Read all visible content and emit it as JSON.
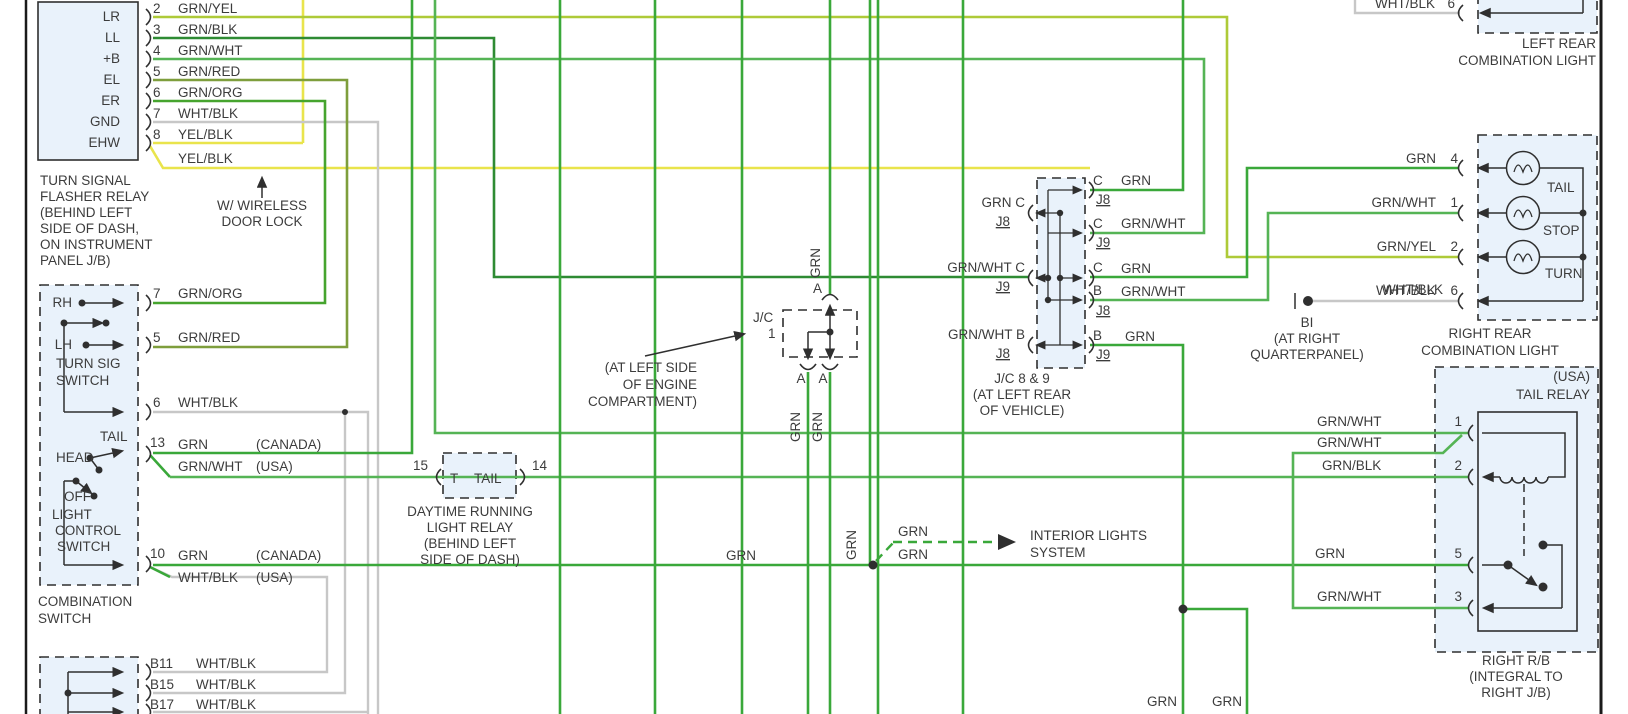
{
  "diagram_title": "Turn signal / tail light wiring diagram section",
  "colors": {
    "grn": "#3aa83a",
    "grnwht": "#55b455",
    "grnblk": "#2e8b33",
    "grnred": "#7e9e3c",
    "grnorg": "#46a42e",
    "grnyel": "#aeca38",
    "yel": "#e9e44c",
    "gry": "#c7c7c7",
    "ink": "#2f2f2f",
    "text": "#3c3c3c",
    "boxfill": "#e9f2fb"
  },
  "components": [
    {
      "name": "turn-signal-flasher-relay",
      "labels": [
        {
          "t": "LR",
          "x": 120,
          "y": 21,
          "a": "end"
        },
        {
          "t": "LL",
          "x": 120,
          "y": 42,
          "a": "end"
        },
        {
          "t": "+B",
          "x": 120,
          "y": 63,
          "a": "end"
        },
        {
          "t": "EL",
          "x": 120,
          "y": 84,
          "a": "end"
        },
        {
          "t": "ER",
          "x": 120,
          "y": 105,
          "a": "end"
        },
        {
          "t": "GND",
          "x": 120,
          "y": 126,
          "a": "end"
        },
        {
          "t": "EHW",
          "x": 120,
          "y": 147,
          "a": "end"
        },
        {
          "t": "2",
          "x": 153,
          "y": 13
        },
        {
          "t": "GRN/YEL",
          "x": 178,
          "y": 13
        },
        {
          "t": "3",
          "x": 153,
          "y": 34
        },
        {
          "t": "GRN/BLK",
          "x": 178,
          "y": 34
        },
        {
          "t": "4",
          "x": 153,
          "y": 55
        },
        {
          "t": "GRN/WHT",
          "x": 178,
          "y": 55
        },
        {
          "t": "5",
          "x": 153,
          "y": 76
        },
        {
          "t": "GRN/RED",
          "x": 178,
          "y": 76
        },
        {
          "t": "6",
          "x": 153,
          "y": 97
        },
        {
          "t": "GRN/ORG",
          "x": 178,
          "y": 97
        },
        {
          "t": "7",
          "x": 153,
          "y": 118
        },
        {
          "t": "WHT/BLK",
          "x": 178,
          "y": 118
        },
        {
          "t": "8",
          "x": 153,
          "y": 139
        },
        {
          "t": "YEL/BLK",
          "x": 178,
          "y": 139
        },
        {
          "t": "YEL/BLK",
          "x": 178,
          "y": 163
        },
        {
          "t": "TURN SIGNAL",
          "x": 40,
          "y": 185
        },
        {
          "t": "FLASHER RELAY",
          "x": 40,
          "y": 201
        },
        {
          "t": "(BEHIND LEFT",
          "x": 40,
          "y": 217
        },
        {
          "t": "SIDE OF DASH,",
          "x": 40,
          "y": 233
        },
        {
          "t": "ON INSTRUMENT",
          "x": 40,
          "y": 249
        },
        {
          "t": "PANEL J/B)",
          "x": 40,
          "y": 265
        },
        {
          "t": "W/ WIRELESS",
          "x": 262,
          "y": 210,
          "a": "middle"
        },
        {
          "t": "DOOR LOCK",
          "x": 262,
          "y": 226,
          "a": "middle"
        }
      ]
    },
    {
      "name": "combination-switch",
      "labels": [
        {
          "t": "RH",
          "x": 72,
          "y": 307,
          "a": "end"
        },
        {
          "t": "LH",
          "x": 72,
          "y": 349,
          "a": "end"
        },
        {
          "t": "TURN SIG",
          "x": 56,
          "y": 368
        },
        {
          "t": "SWITCH",
          "x": 56,
          "y": 385
        },
        {
          "t": "7",
          "x": 153,
          "y": 298
        },
        {
          "t": "GRN/ORG",
          "x": 178,
          "y": 298
        },
        {
          "t": "5",
          "x": 153,
          "y": 342
        },
        {
          "t": "GRN/RED",
          "x": 178,
          "y": 342
        },
        {
          "t": "6",
          "x": 153,
          "y": 407
        },
        {
          "t": "WHT/BLK",
          "x": 178,
          "y": 407
        },
        {
          "t": "TAIL",
          "x": 100,
          "y": 441
        },
        {
          "t": "HEAD",
          "x": 56,
          "y": 462
        },
        {
          "t": "13",
          "x": 150,
          "y": 447
        },
        {
          "t": "GRN",
          "x": 178,
          "y": 449
        },
        {
          "t": "(CANADA)",
          "x": 256,
          "y": 449
        },
        {
          "t": "GRN/WHT",
          "x": 178,
          "y": 471
        },
        {
          "t": "(USA)",
          "x": 256,
          "y": 471
        },
        {
          "t": "OFF",
          "x": 64,
          "y": 501
        },
        {
          "t": "LIGHT",
          "x": 52,
          "y": 519
        },
        {
          "t": "CONTROL",
          "x": 55,
          "y": 535
        },
        {
          "t": "SWITCH",
          "x": 57,
          "y": 551
        },
        {
          "t": "10",
          "x": 150,
          "y": 558
        },
        {
          "t": "GRN",
          "x": 178,
          "y": 560
        },
        {
          "t": "(CANADA)",
          "x": 256,
          "y": 560
        },
        {
          "t": "WHT/BLK",
          "x": 178,
          "y": 582
        },
        {
          "t": "(USA)",
          "x": 256,
          "y": 582
        },
        {
          "t": "COMBINATION",
          "x": 38,
          "y": 606
        },
        {
          "t": "SWITCH",
          "x": 38,
          "y": 623
        }
      ]
    },
    {
      "name": "instrument-panel-connector",
      "labels": [
        {
          "t": "B11",
          "x": 150,
          "y": 668
        },
        {
          "t": "WHT/BLK",
          "x": 196,
          "y": 668
        },
        {
          "t": "B15",
          "x": 150,
          "y": 689
        },
        {
          "t": "WHT/BLK",
          "x": 196,
          "y": 689
        },
        {
          "t": "B17",
          "x": 150,
          "y": 709
        },
        {
          "t": "WHT/BLK",
          "x": 196,
          "y": 709
        }
      ]
    },
    {
      "name": "daytime-running-light-relay",
      "labels": [
        {
          "t": "15",
          "x": 428,
          "y": 470,
          "a": "end"
        },
        {
          "t": "T",
          "x": 450,
          "y": 483
        },
        {
          "t": "TAIL",
          "x": 474,
          "y": 483
        },
        {
          "t": "14",
          "x": 532,
          "y": 470
        },
        {
          "t": "DAYTIME RUNNING",
          "x": 470,
          "y": 516,
          "a": "middle"
        },
        {
          "t": "LIGHT RELAY",
          "x": 470,
          "y": 532,
          "a": "middle"
        },
        {
          "t": "(BEHIND LEFT",
          "x": 470,
          "y": 548,
          "a": "middle"
        },
        {
          "t": "SIDE OF DASH)",
          "x": 470,
          "y": 564,
          "a": "middle"
        }
      ]
    },
    {
      "name": "junction-connector-1",
      "labels": [
        {
          "t": "A",
          "x": 822,
          "y": 293,
          "a": "end"
        },
        {
          "t": "J/C",
          "x": 753,
          "y": 322
        },
        {
          "t": "1",
          "x": 768,
          "y": 338
        },
        {
          "t": "A",
          "x": 801,
          "y": 383,
          "a": "middle"
        },
        {
          "t": "A",
          "x": 823,
          "y": 383,
          "a": "middle"
        },
        {
          "t": "GRN",
          "x": 820,
          "y": 278,
          "r": true
        },
        {
          "t": "GRN",
          "x": 800,
          "y": 442,
          "r": true
        },
        {
          "t": "GRN",
          "x": 822,
          "y": 442,
          "r": true
        },
        {
          "t": "(AT LEFT SIDE",
          "x": 697,
          "y": 372,
          "a": "end"
        },
        {
          "t": "OF ENGINE",
          "x": 697,
          "y": 389,
          "a": "end"
        },
        {
          "t": "COMPARTMENT)",
          "x": 697,
          "y": 406,
          "a": "end"
        }
      ]
    },
    {
      "name": "junction-connector-8-9",
      "labels": [
        {
          "t": "GRN  C",
          "x": 1025,
          "y": 207,
          "a": "end"
        },
        {
          "t": "J8",
          "x": 1010,
          "y": 226,
          "a": "end",
          "u": true
        },
        {
          "t": "GRN/WHT  C",
          "x": 1025,
          "y": 272,
          "a": "end"
        },
        {
          "t": "J9",
          "x": 1010,
          "y": 291,
          "a": "end",
          "u": true
        },
        {
          "t": "GRN/WHT  B",
          "x": 1025,
          "y": 339,
          "a": "end"
        },
        {
          "t": "J8",
          "x": 1010,
          "y": 358,
          "a": "end",
          "u": true
        },
        {
          "t": "C",
          "x": 1093,
          "y": 185
        },
        {
          "t": "GRN",
          "x": 1121,
          "y": 185
        },
        {
          "t": "J8",
          "x": 1096,
          "y": 204,
          "u": true
        },
        {
          "t": "C",
          "x": 1093,
          "y": 228
        },
        {
          "t": "GRN/WHT",
          "x": 1121,
          "y": 228
        },
        {
          "t": "J9",
          "x": 1096,
          "y": 247,
          "u": true
        },
        {
          "t": "C",
          "x": 1093,
          "y": 272
        },
        {
          "t": "GRN",
          "x": 1121,
          "y": 273
        },
        {
          "t": "B",
          "x": 1093,
          "y": 295
        },
        {
          "t": "GRN/WHT",
          "x": 1121,
          "y": 296
        },
        {
          "t": "J8",
          "x": 1096,
          "y": 315,
          "u": true
        },
        {
          "t": "B",
          "x": 1093,
          "y": 340
        },
        {
          "t": "GRN",
          "x": 1125,
          "y": 341
        },
        {
          "t": "J9",
          "x": 1096,
          "y": 359,
          "u": true
        },
        {
          "t": "J/C 8 & 9",
          "x": 1022,
          "y": 383,
          "a": "middle"
        },
        {
          "t": "(AT LEFT REAR",
          "x": 1022,
          "y": 399,
          "a": "middle"
        },
        {
          "t": "OF VEHICLE)",
          "x": 1022,
          "y": 415,
          "a": "middle"
        }
      ]
    },
    {
      "name": "ground-bi",
      "labels": [
        {
          "t": "WHT/BLK",
          "x": 1383,
          "y": 294
        },
        {
          "t": "BI",
          "x": 1307,
          "y": 327,
          "a": "middle"
        },
        {
          "t": "(AT RIGHT",
          "x": 1307,
          "y": 343,
          "a": "middle"
        },
        {
          "t": "QUARTERPANEL)",
          "x": 1307,
          "y": 359,
          "a": "middle"
        }
      ]
    },
    {
      "name": "right-rear-combination-light",
      "labels": [
        {
          "t": "GRN",
          "x": 1436,
          "y": 163,
          "a": "end"
        },
        {
          "t": "4",
          "x": 1458,
          "y": 163,
          "a": "end"
        },
        {
          "t": "GRN/WHT",
          "x": 1436,
          "y": 207,
          "a": "end"
        },
        {
          "t": "1",
          "x": 1458,
          "y": 207,
          "a": "end"
        },
        {
          "t": "GRN/YEL",
          "x": 1436,
          "y": 251,
          "a": "end"
        },
        {
          "t": "2",
          "x": 1458,
          "y": 251,
          "a": "end"
        },
        {
          "t": "WHT/BLK",
          "x": 1436,
          "y": 295,
          "a": "end"
        },
        {
          "t": "6",
          "x": 1458,
          "y": 295,
          "a": "end"
        },
        {
          "t": "TAIL",
          "x": 1547,
          "y": 192
        },
        {
          "t": "STOP",
          "x": 1543,
          "y": 235
        },
        {
          "t": "TURN",
          "x": 1545,
          "y": 278
        },
        {
          "t": "RIGHT REAR",
          "x": 1490,
          "y": 338,
          "a": "middle"
        },
        {
          "t": "COMBINATION LIGHT",
          "x": 1490,
          "y": 355,
          "a": "middle"
        }
      ]
    },
    {
      "name": "left-rear-combination-light",
      "labels": [
        {
          "t": "WHT/BLK",
          "x": 1435,
          "y": 8,
          "a": "end"
        },
        {
          "t": "6",
          "x": 1455,
          "y": 8,
          "a": "end"
        },
        {
          "t": "LEFT REAR",
          "x": 1596,
          "y": 48,
          "a": "end"
        },
        {
          "t": "COMBINATION LIGHT",
          "x": 1596,
          "y": 65,
          "a": "end"
        }
      ]
    },
    {
      "name": "tail-relay",
      "labels": [
        {
          "t": "(USA)",
          "x": 1590,
          "y": 381,
          "a": "end"
        },
        {
          "t": "TAIL RELAY",
          "x": 1590,
          "y": 399,
          "a": "end"
        },
        {
          "t": "1",
          "x": 1462,
          "y": 426,
          "a": "end"
        },
        {
          "t": "2",
          "x": 1462,
          "y": 470,
          "a": "end"
        },
        {
          "t": "5",
          "x": 1462,
          "y": 558,
          "a": "end"
        },
        {
          "t": "3",
          "x": 1462,
          "y": 601,
          "a": "end"
        },
        {
          "t": "GRN/WHT",
          "x": 1317,
          "y": 426
        },
        {
          "t": "GRN/WHT",
          "x": 1317,
          "y": 447
        },
        {
          "t": "GRN/BLK",
          "x": 1322,
          "y": 470
        },
        {
          "t": "GRN",
          "x": 1315,
          "y": 558
        },
        {
          "t": "GRN/WHT",
          "x": 1317,
          "y": 601
        },
        {
          "t": "RIGHT R/B",
          "x": 1516,
          "y": 665,
          "a": "middle"
        },
        {
          "t": "(INTEGRAL TO",
          "x": 1516,
          "y": 681,
          "a": "middle"
        },
        {
          "t": "RIGHT J/B)",
          "x": 1516,
          "y": 697,
          "a": "middle"
        }
      ]
    },
    {
      "name": "interior-lights-system",
      "labels": [
        {
          "t": "GRN",
          "x": 726,
          "y": 560
        },
        {
          "t": "GRN",
          "x": 856,
          "y": 560,
          "r": true
        },
        {
          "t": "GRN",
          "x": 898,
          "y": 536
        },
        {
          "t": "GRN",
          "x": 898,
          "y": 559
        },
        {
          "t": "INTERIOR LIGHTS",
          "x": 1030,
          "y": 540
        },
        {
          "t": "SYSTEM",
          "x": 1030,
          "y": 557
        },
        {
          "t": "GRN",
          "x": 1177,
          "y": 706,
          "a": "end"
        },
        {
          "t": "GRN",
          "x": 1242,
          "y": 706,
          "a": "end"
        }
      ]
    }
  ]
}
